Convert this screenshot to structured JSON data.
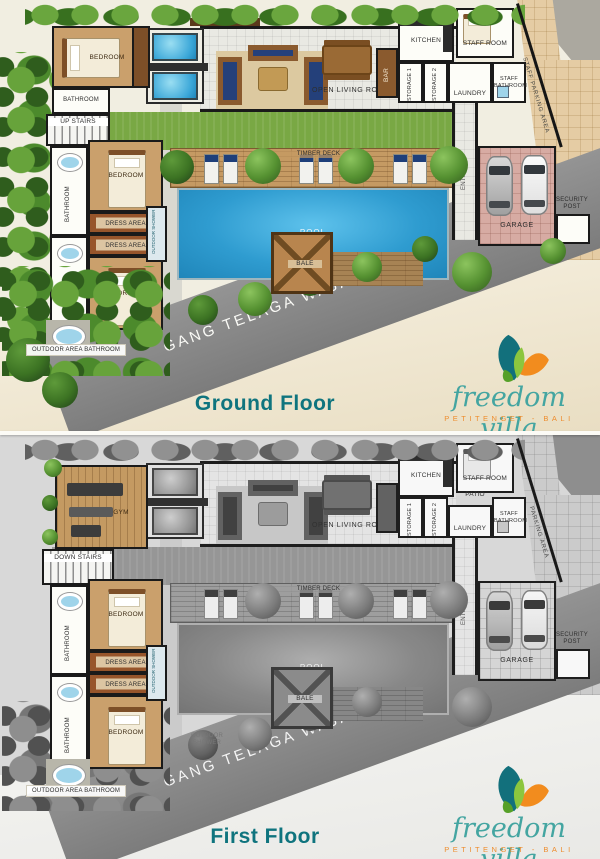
{
  "street": "GANG TELAGA WAJA",
  "floors": {
    "ground": {
      "title": "Ground Floor"
    },
    "first": {
      "title": "First Floor"
    }
  },
  "brand": {
    "name": "freedom villa",
    "tagline": "PETITENGET - BALI"
  },
  "labels": {
    "bedroom": "BEDROOM",
    "bathroom": "BATHROOM",
    "up_stairs": "UP STAIRS",
    "down_stairs": "DOWN STAIRS",
    "gym": "GYM",
    "kitchen": "KITCHEN",
    "staff_room": "STAFF ROOM",
    "storage_1": "STORAGE 1",
    "storage_2": "STORAGE 2",
    "laundry": "LAUNDRY",
    "staff_bathroom": "STAFF BATHROOM",
    "staff_parking_area": "STAFF PARKING AREA",
    "parking_area": "PARKING AREA",
    "patio": "PATIO",
    "open_living_room": "OPEN LIVING ROOM",
    "bar": "BAR",
    "timber_deck": "TIMBER DECK",
    "pool": "POOL",
    "bale": "BALE",
    "entrance": "ENTRANCE",
    "garage": "GARAGE",
    "security_post": "SECURITY POST",
    "dress_area": "DRESS AREA",
    "outdoor_shower": "OUTDOOR SHOWER",
    "outdoor_area_bathroom": "OUTDOOR AREA BATHROOM"
  },
  "colors": {
    "title_teal": "#0f747e",
    "brand_teal": "#44a5a1",
    "brand_orange": "#ee8d2e",
    "pool_blue": "#2f9cd0",
    "road_gray": "#8a8a8a",
    "deck_wood": "#c59a63",
    "lawn_green": "#79a844",
    "garage_paving": "#d7aba3"
  }
}
